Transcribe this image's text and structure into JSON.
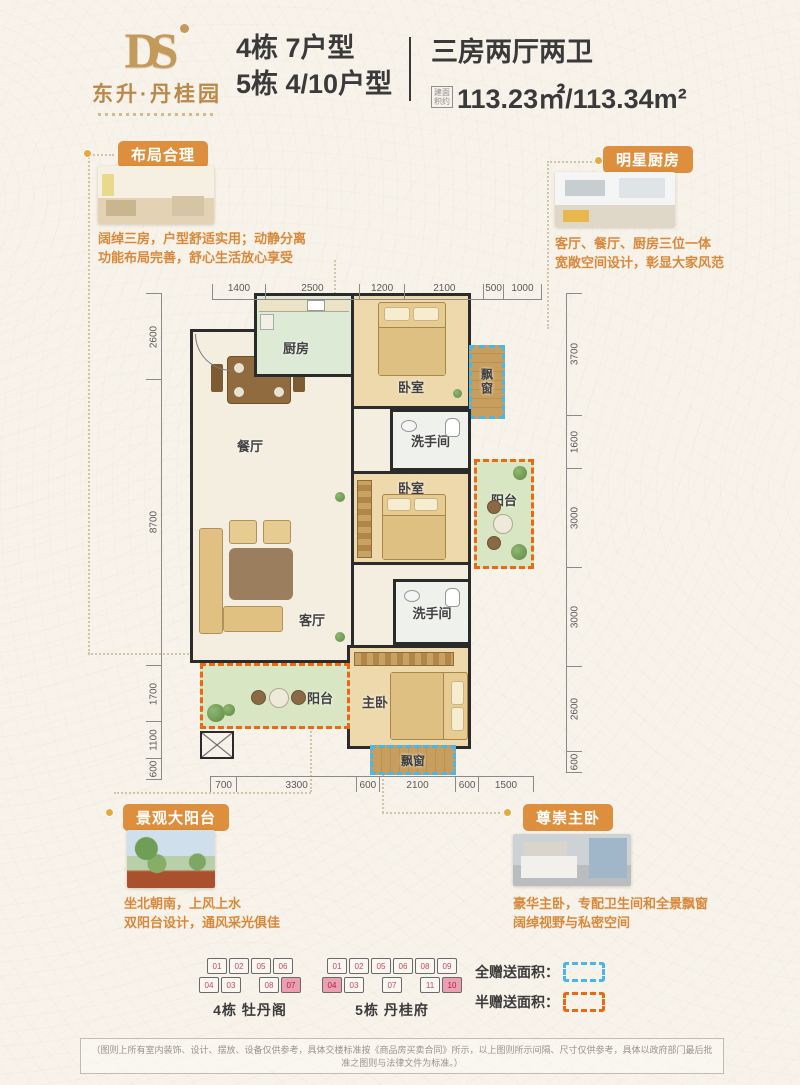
{
  "header": {
    "logo_monogram": "DS",
    "logo_name": "东升·丹桂园",
    "building_line1": "4栋 7户型",
    "building_line2": "5栋 4/10户型",
    "type_title": "三房两厅两卫",
    "area_label_line1": "建面",
    "area_label_line2": "积约",
    "area_value": "113.23㎡/113.34m²"
  },
  "callouts": {
    "layout": {
      "badge": "布局合理",
      "line1": "阔绰三房，户型舒适实用；动静分离",
      "line2": "功能布局完善，舒心生活放心享受"
    },
    "kitchen": {
      "badge": "明星厨房",
      "line1": "客厅、餐厅、厨房三位一体",
      "line2": "宽敞空间设计，彰显大家风范"
    },
    "balcony": {
      "badge": "景观大阳台",
      "line1": "坐北朝南，上风上水",
      "line2": "双阳台设计，通风采光俱佳"
    },
    "master": {
      "badge": "尊崇主卧",
      "line1": "豪华主卧，专配卫生间和全景飘窗",
      "line2": "阔绰视野与私密空间"
    }
  },
  "floorplan": {
    "labels": {
      "kitchen": "厨房",
      "bedroom_top": "卧室",
      "bay_top": "飘窗",
      "dining": "餐厅",
      "bath1": "洗手间",
      "bedroom_mid": "卧室",
      "balcony_right": "阳台",
      "living": "客厅",
      "bath2": "洗手间",
      "master": "主卧",
      "balcony_left": "阳台",
      "bay_bottom": "飘窗"
    },
    "rulers": {
      "top": [
        1400,
        2500,
        1200,
        2100,
        500,
        1000
      ],
      "bottom": [
        700,
        3300,
        600,
        2100,
        600,
        1500
      ],
      "left": [
        2600,
        8700,
        1700,
        1100,
        600
      ],
      "right": [
        3700,
        1600,
        3000,
        3000,
        2600,
        600
      ]
    }
  },
  "buildings": [
    {
      "name": "4栋 牡丹阁",
      "rows": [
        [
          "01",
          "02",
          "05",
          "06"
        ],
        [
          "04",
          "03",
          "",
          "08",
          "07*"
        ]
      ]
    },
    {
      "name": "5栋 丹桂府",
      "rows": [
        [
          "01",
          "02",
          "05",
          "06",
          "08",
          "09"
        ],
        [
          "04*",
          "03",
          "",
          "07",
          "",
          "11",
          "10*"
        ]
      ]
    }
  ],
  "legend": {
    "full_label": "全赠送面积：",
    "half_label": "半赠送面积：",
    "full_color": "#49b8e8",
    "half_color": "#ea6a14"
  },
  "colors": {
    "accent_orange": "#dd8f3d",
    "text_orange": "#d8883b",
    "gold": "#bd8f52",
    "dashed_blue": "#49b8e8",
    "dashed_orange": "#ea6a14",
    "unit_highlight": "#ec9fb1"
  },
  "disclaimer": "（图则上所有室内装饰、设计、摆放、设备仅供参考，具体交楼标准按《商品房买卖合同》所示，以上图则所示间隔、尺寸仅供参考，具体以政府部门最后批准之图则与法律文件为标准。）"
}
